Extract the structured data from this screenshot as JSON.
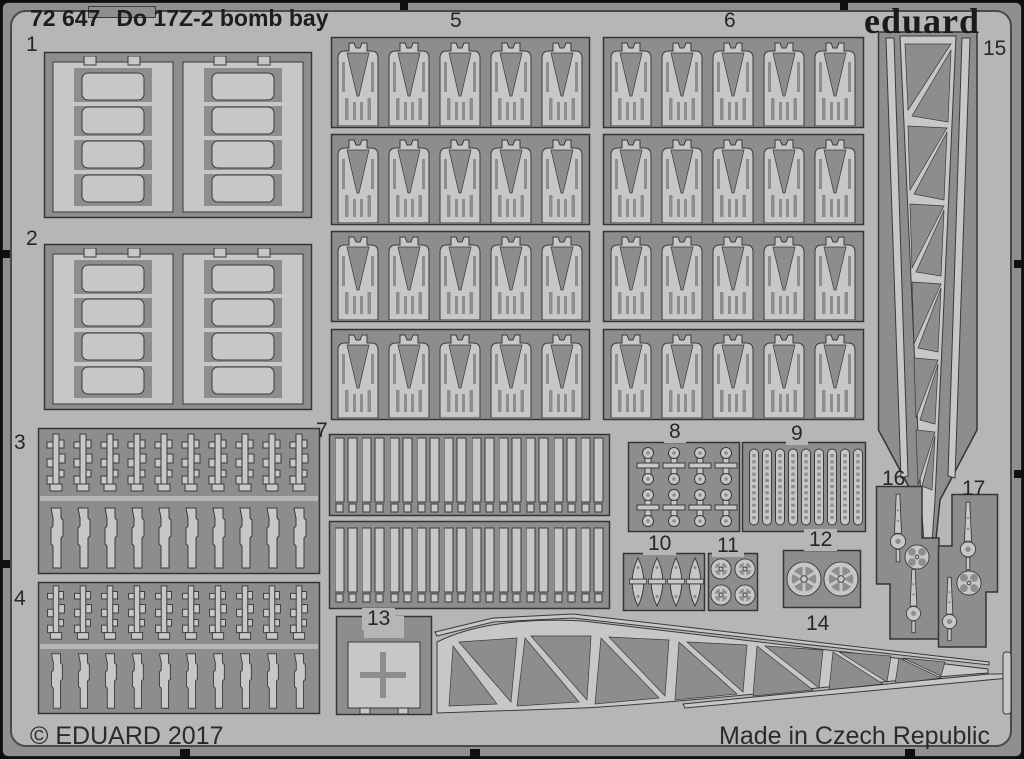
{
  "product": {
    "catalog_number": "72 647",
    "name": "Do 17Z-2 bomb bay",
    "brand": "eduard"
  },
  "footer": {
    "copyright": "© EDUARD 2017",
    "origin": "Made in Czech Republic"
  },
  "parts": [
    {
      "number": "1"
    },
    {
      "number": "2"
    },
    {
      "number": "3"
    },
    {
      "number": "4"
    },
    {
      "number": "5"
    },
    {
      "number": "6"
    },
    {
      "number": "7"
    },
    {
      "number": "8"
    },
    {
      "number": "9"
    },
    {
      "number": "10"
    },
    {
      "number": "11"
    },
    {
      "number": "12"
    },
    {
      "number": "13"
    },
    {
      "number": "14"
    },
    {
      "number": "15"
    },
    {
      "number": "16"
    },
    {
      "number": "17"
    }
  ],
  "colors": {
    "photo_background": "#0e0e0e",
    "frame": "#8f8f8d",
    "sheet": "#b6b6b4",
    "etched_background": "#8d8d8b",
    "part_surface": "#c7c7c5",
    "outline": "#3a3a38",
    "text": "#26262a"
  }
}
